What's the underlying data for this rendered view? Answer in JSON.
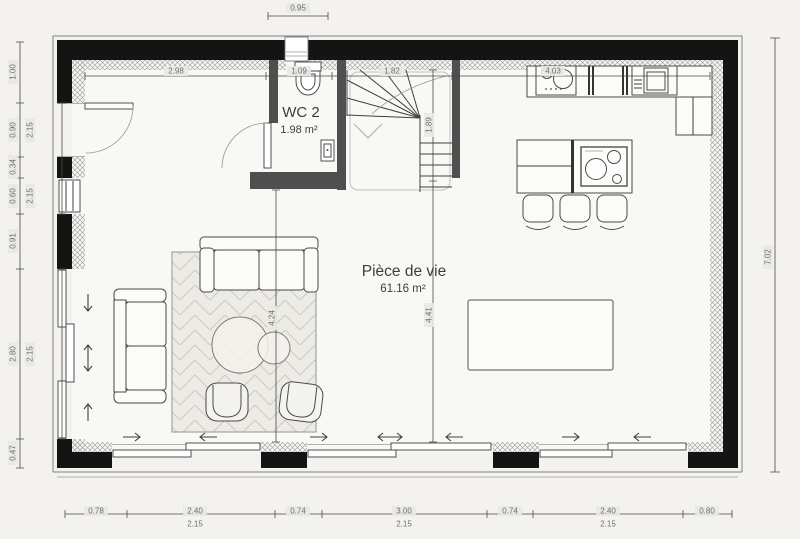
{
  "rooms": [
    {
      "id": "wc",
      "name": "WC 2",
      "area": "1.98 m²"
    },
    {
      "id": "living",
      "name": "Pièce de vie",
      "area": "61.16 m²"
    }
  ],
  "dims": {
    "top_exterior": [
      "0.95"
    ],
    "top_interior": [
      "2.98",
      "1.09",
      "1.82",
      "4.03"
    ],
    "left_outer": [
      "1.00",
      "0.90",
      "0.34",
      "0.60",
      "0.91",
      "2.80",
      "0.47"
    ],
    "left_inner": [
      "2.15",
      "2.15",
      "2.15"
    ],
    "right": [
      "7.02"
    ],
    "bottom_outer": [
      "0.78",
      "2.40",
      "0.74",
      "3.00",
      "0.74",
      "2.40",
      "0.80"
    ],
    "bottom_inner": [
      "2.15",
      "2.15",
      "2.15"
    ],
    "stair_depth": [
      "1.89"
    ],
    "living_heights": [
      "4.24",
      "4.41"
    ]
  },
  "colors": {
    "wall": "#141414",
    "partition": "#4f4f4f",
    "dim_text": "#6e6e6e",
    "badge": "#e9e8e3",
    "paper": "#f3f2ef",
    "floor": "#f8f8f5"
  }
}
